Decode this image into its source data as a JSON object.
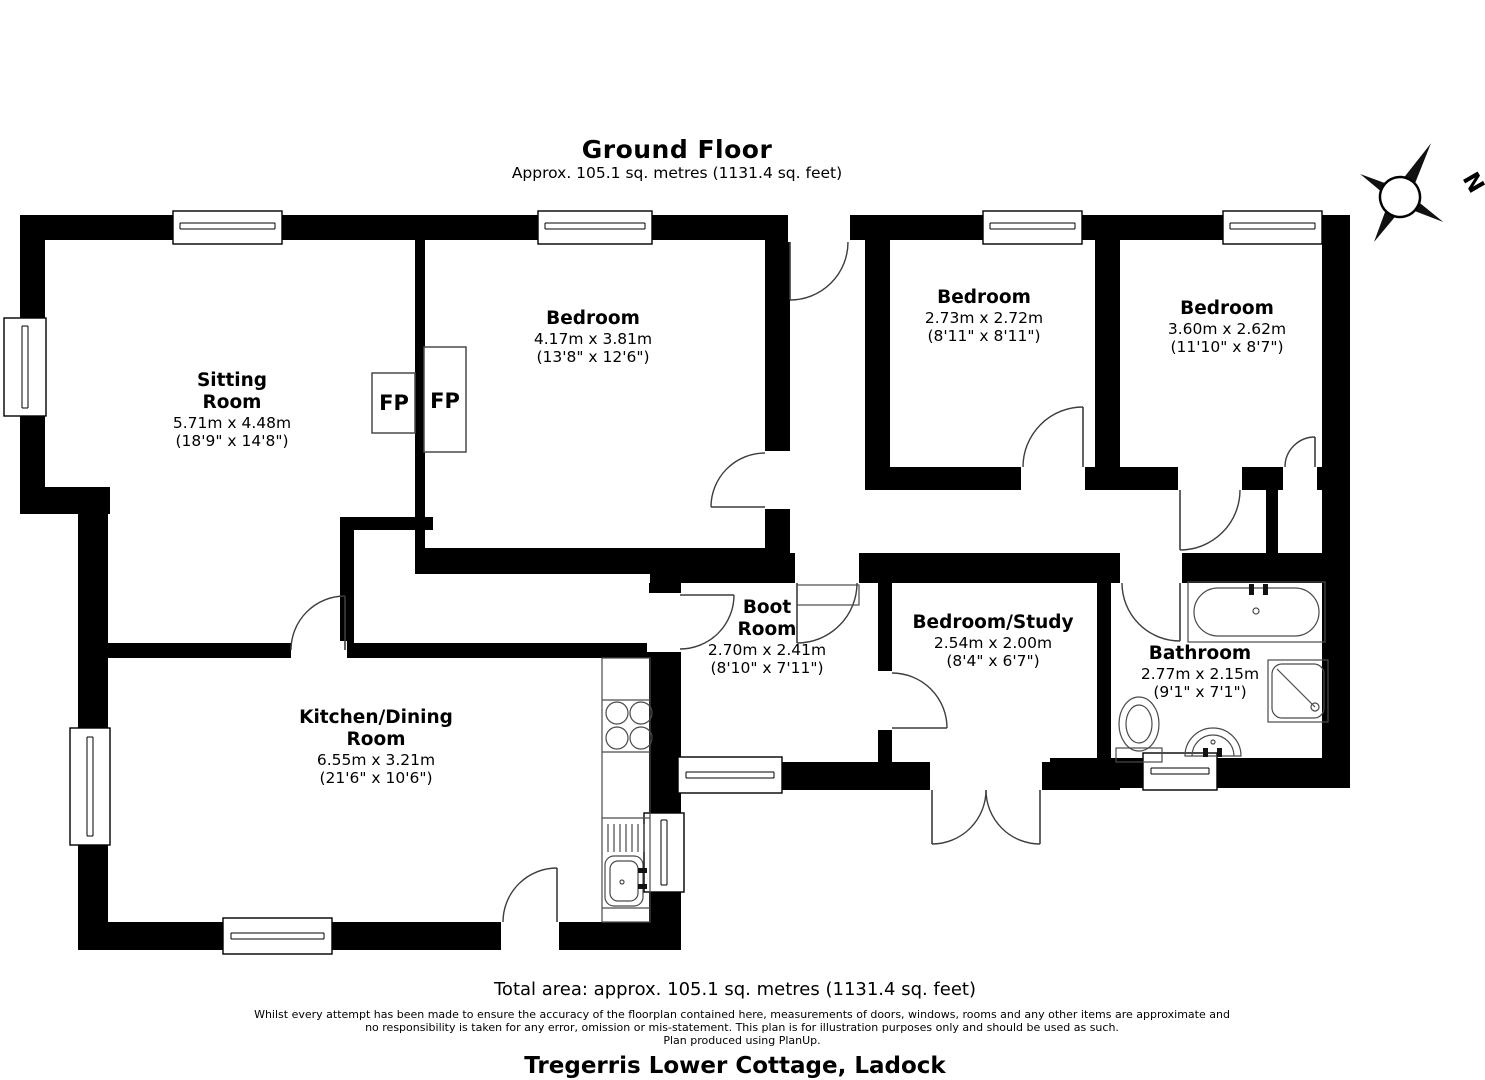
{
  "header": {
    "title": "Ground Floor",
    "subtitle": "Approx. 105.1 sq. metres (1131.4 sq. feet)"
  },
  "compass": {
    "north_label": "N"
  },
  "fireplaces": {
    "left": "FP",
    "right": "FP"
  },
  "rooms": {
    "sitting": {
      "name": "Sitting\nRoom",
      "metric": "5.71m x 4.48m",
      "imperial": "(18'9\" x 14'8\")"
    },
    "bedroom1": {
      "name": "Bedroom",
      "metric": "4.17m x 3.81m",
      "imperial": "(13'8\" x 12'6\")"
    },
    "bedroom2": {
      "name": "Bedroom",
      "metric": "2.73m x 2.72m",
      "imperial": "(8'11\" x 8'11\")"
    },
    "bedroom3": {
      "name": "Bedroom",
      "metric": "3.60m x 2.62m",
      "imperial": "(11'10\" x 8'7\")"
    },
    "boot": {
      "name": "Boot\nRoom",
      "metric": "2.70m x 2.41m",
      "imperial": "(8'10\" x 7'11\")"
    },
    "study": {
      "name": "Bedroom/Study",
      "metric": "2.54m x 2.00m",
      "imperial": "(8'4\" x 6'7\")"
    },
    "bathroom": {
      "name": "Bathroom",
      "metric": "2.77m x 2.15m",
      "imperial": "(9'1\" x 7'1\")"
    },
    "kitchen": {
      "name": "Kitchen/Dining\nRoom",
      "metric": "6.55m x 3.21m",
      "imperial": "(21'6\" x 10'6\")"
    }
  },
  "footer": {
    "total_area": "Total area: approx. 105.1 sq. metres (1131.4 sq. feet)",
    "disclaimer_line1": "Whilst every attempt has been made to ensure the accuracy of the floorplan contained here, measurements of doors, windows, rooms and any other items are approximate and",
    "disclaimer_line2": "no responsibility is taken for any error, omission or mis-statement. This plan is for illustration purposes only and should be used as such.",
    "disclaimer_line3": "Plan produced using PlanUp.",
    "property_title": "Tregerris Lower Cottage, Ladock"
  }
}
